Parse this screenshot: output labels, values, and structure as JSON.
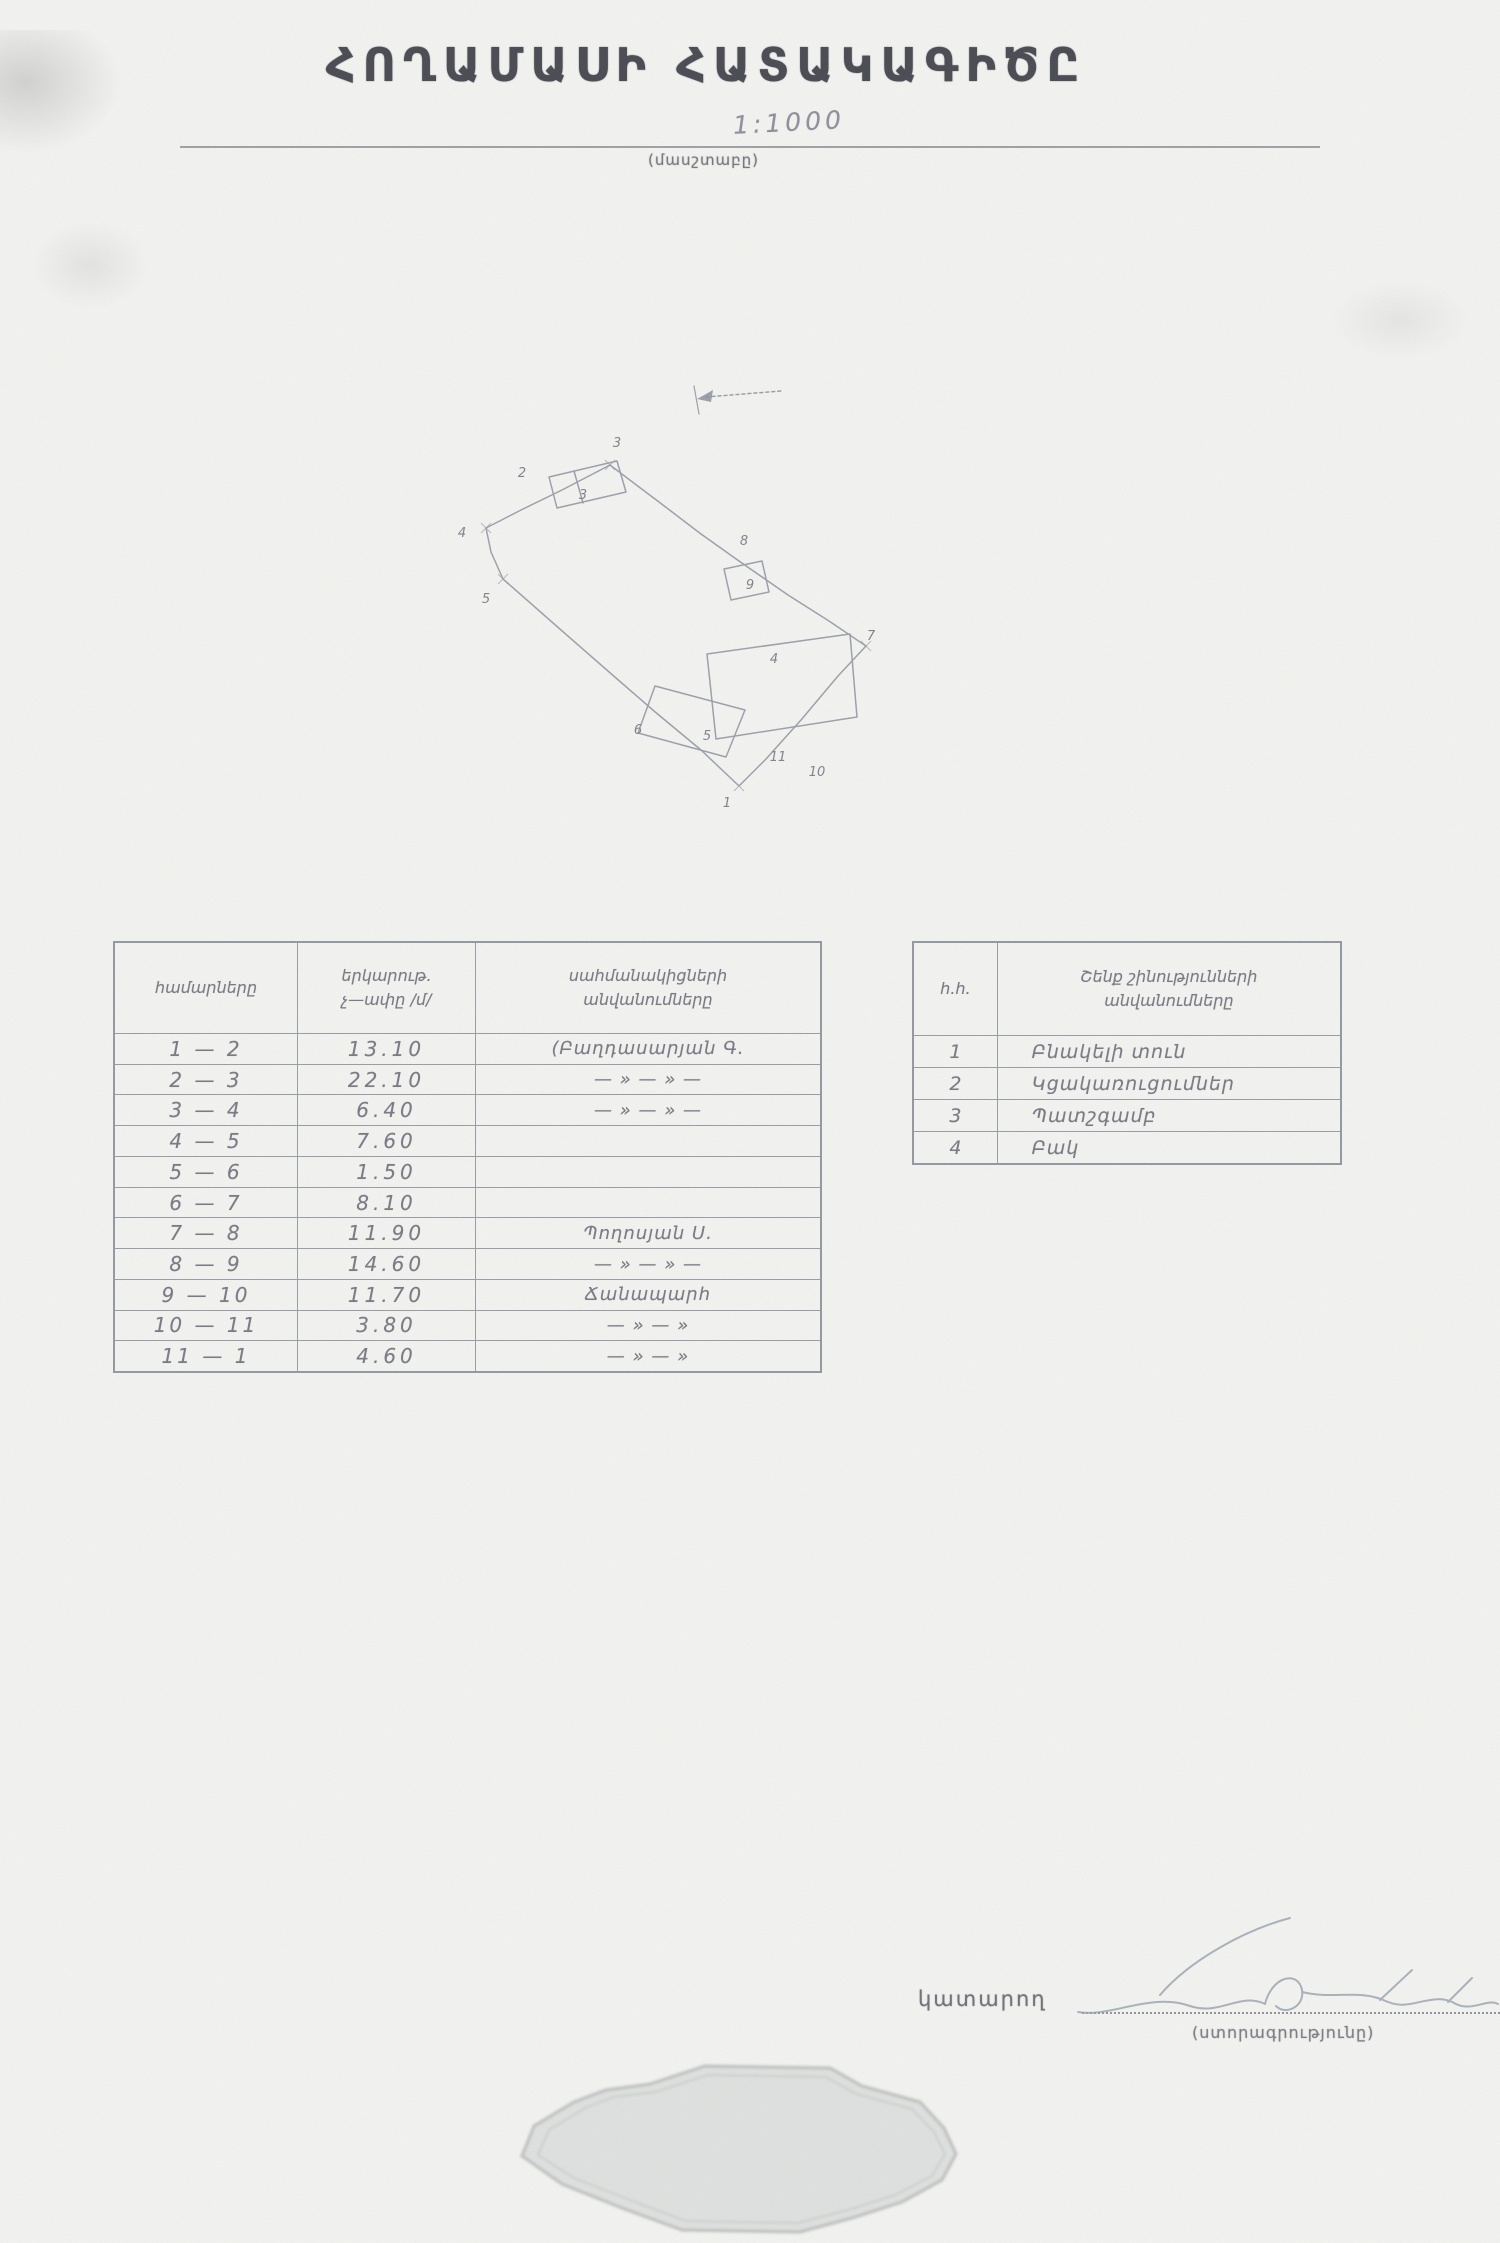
{
  "document": {
    "title": "ՀՈՂԱՄԱՍԻ ՀԱՏԱԿԱԳԻԾԸ",
    "scale_value": "1:1000",
    "scale_caption": "(մասշտաբը)"
  },
  "plan_sketch": {
    "vertex_labels": [
      "1",
      "2",
      "3",
      "4",
      "5",
      "6",
      "7",
      "8",
      "9",
      "10",
      "11"
    ],
    "structure_labels": [
      "3",
      "4",
      "5"
    ]
  },
  "boundaries_table": {
    "header": {
      "col1": "համարները",
      "col2_line1": "երկարութ.",
      "col2_line2": "չ—ափը /մ/",
      "col3_line1": "սահմանակիցների",
      "col3_line2": "անվանումները"
    },
    "rows": [
      {
        "segment": "1 — 2",
        "length": "13.10",
        "neighbor": "(Բաղդասարյան Գ."
      },
      {
        "segment": "2 — 3",
        "length": "22.10",
        "neighbor": "— » — » —"
      },
      {
        "segment": "3 — 4",
        "length": "6.40",
        "neighbor": "— » — » —"
      },
      {
        "segment": "4 — 5",
        "length": "7.60",
        "neighbor": ""
      },
      {
        "segment": "5 — 6",
        "length": "1.50",
        "neighbor": ""
      },
      {
        "segment": "6 — 7",
        "length": "8.10",
        "neighbor": ""
      },
      {
        "segment": "7 — 8",
        "length": "11.90",
        "neighbor": "Պողոսյան Ս."
      },
      {
        "segment": "8 — 9",
        "length": "14.60",
        "neighbor": "— » — » —"
      },
      {
        "segment": "9 — 10",
        "length": "11.70",
        "neighbor": "Ճանապարհ"
      },
      {
        "segment": "10 — 11",
        "length": "3.80",
        "neighbor": "— » — »"
      },
      {
        "segment": "11 — 1",
        "length": "4.60",
        "neighbor": "— » — »"
      }
    ]
  },
  "structures_table": {
    "header": {
      "col1": "հ.հ.",
      "col2_line1": "Շենք շինությունների",
      "col2_line2": "անվանումները"
    },
    "rows": [
      {
        "num": "1",
        "name": "Բնակելի տուն"
      },
      {
        "num": "2",
        "name": "Կցակառուցումներ"
      },
      {
        "num": "3",
        "name": "Պատշգամբ"
      },
      {
        "num": "4",
        "name": "Բակ"
      }
    ]
  },
  "footer": {
    "executor_label": "կատարող",
    "signature_caption": "(ստորագրությունը)"
  },
  "colors": {
    "ink": "#45454d",
    "pencil": "#8b8f9a",
    "table_line": "#80868f",
    "stamp_fill": "#d0d3d2"
  }
}
